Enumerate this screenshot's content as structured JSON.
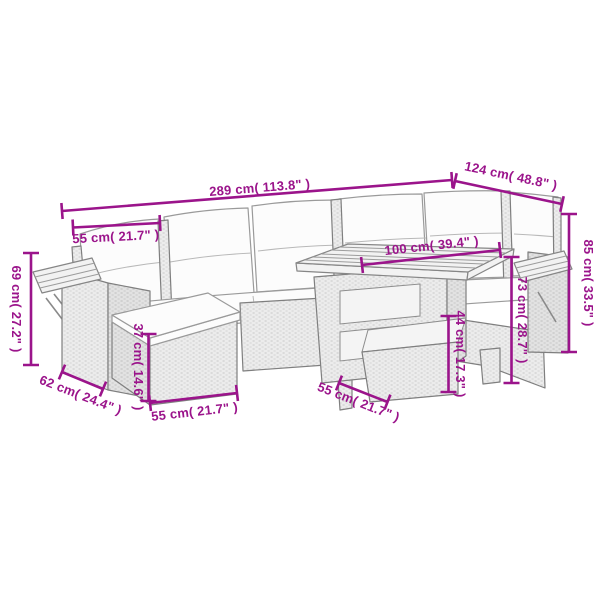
{
  "accent_color": "#9B148B",
  "measurements": {
    "sofa_width": {
      "cm": 289,
      "in": 113.8,
      "label": "289 cm( 113.8\" )"
    },
    "corner_depth": {
      "cm": 124,
      "in": 48.8,
      "label": "124 cm( 48.8\" )"
    },
    "seat_width": {
      "cm": 55,
      "in": 21.7,
      "label": "55 cm( 21.7\" )"
    },
    "table_length": {
      "cm": 100,
      "in": 39.4,
      "label": "100 cm( 39.4\" )"
    },
    "total_height": {
      "cm": 85,
      "in": 33.5,
      "label": "85 cm( 33.5\" )"
    },
    "armrest_height": {
      "cm": 73,
      "in": 28.7,
      "label": "73 cm( 28.7\" )"
    },
    "stool_height": {
      "cm": 44,
      "in": 17.3,
      "label": "44 cm( 17.3\" )"
    },
    "shelf_height": {
      "cm": 69,
      "in": 27.2,
      "label": "69 cm( 27.2\" )"
    },
    "armrest_depth": {
      "cm": 62,
      "in": 24.4,
      "label": "62 cm( 24.4\" )"
    },
    "ottoman_height": {
      "cm": 37,
      "in": 14.6,
      "label": "37 cm( 14.6\" )"
    },
    "ottoman_width": {
      "cm": 55,
      "in": 21.7,
      "label": "55 cm( 21.7\" )"
    },
    "stool_width": {
      "cm": 55,
      "in": 21.7,
      "label": "55 cm( 21.7\" )"
    }
  }
}
